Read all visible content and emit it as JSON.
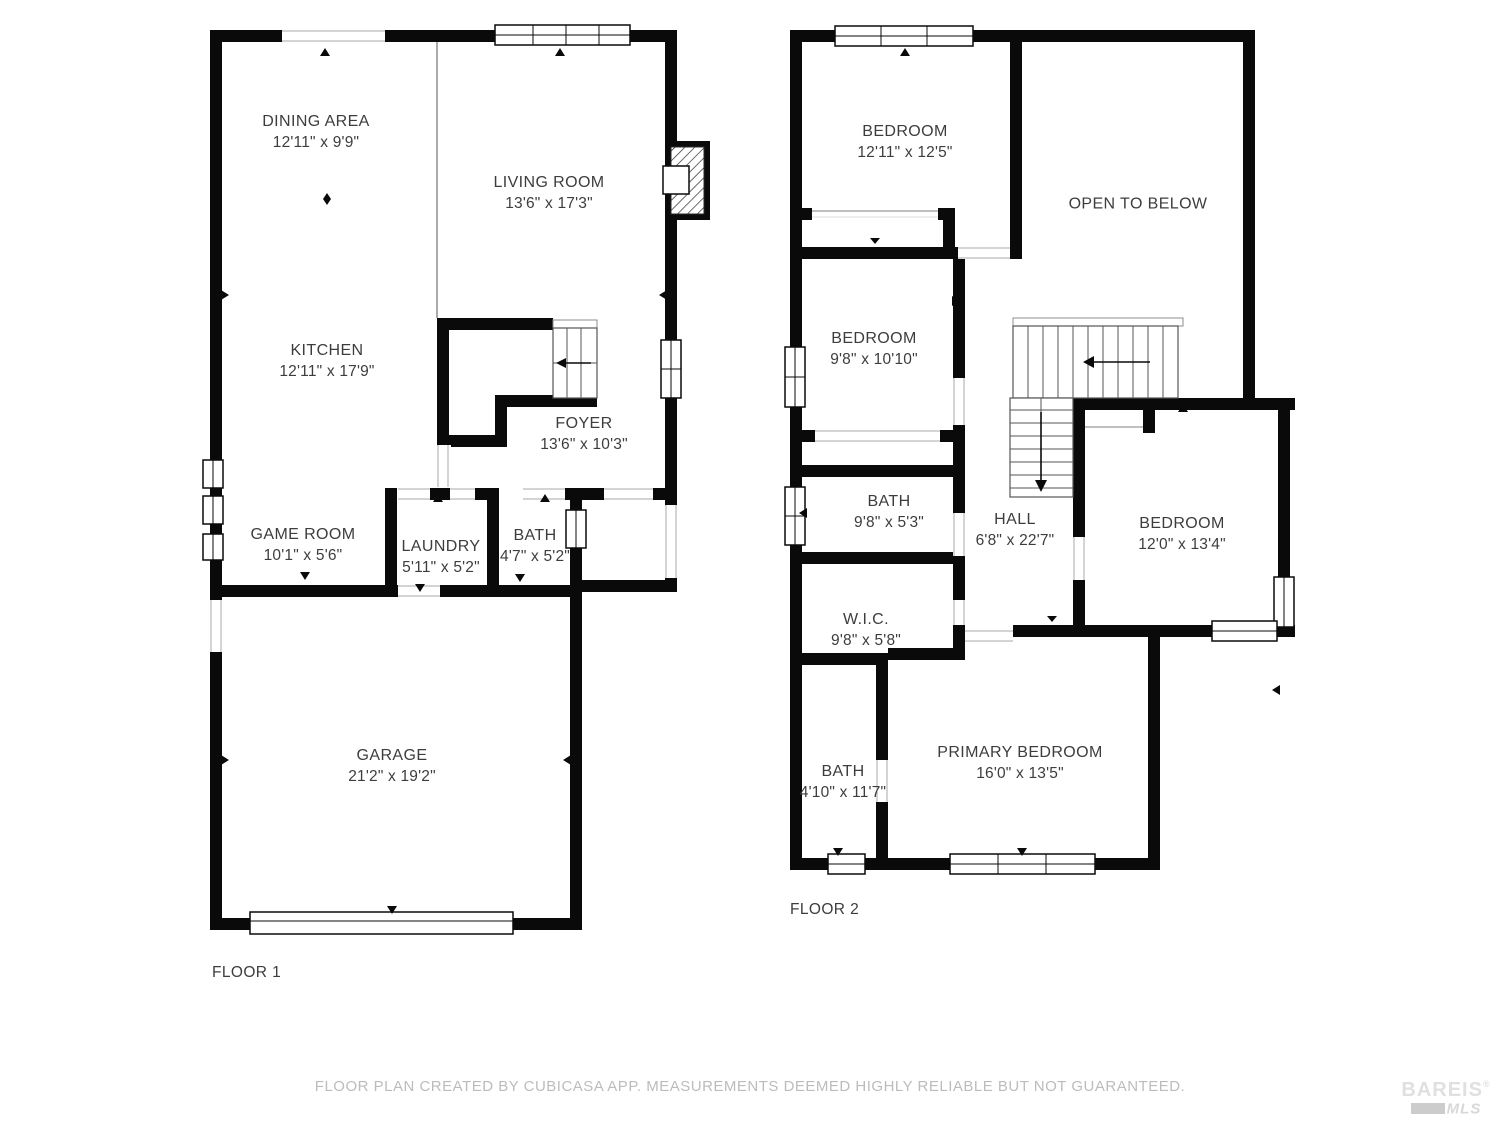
{
  "floors": [
    {
      "label": "FLOOR 1",
      "rooms": [
        {
          "name": "DINING AREA",
          "dims": "12'11\" x 9'9\""
        },
        {
          "name": "LIVING ROOM",
          "dims": "13'6\" x 17'3\""
        },
        {
          "name": "KITCHEN",
          "dims": "12'11\" x 17'9\""
        },
        {
          "name": "FOYER",
          "dims": "13'6\" x 10'3\""
        },
        {
          "name": "GAME ROOM",
          "dims": "10'1\" x 5'6\""
        },
        {
          "name": "LAUNDRY",
          "dims": "5'11\" x 5'2\""
        },
        {
          "name": "BATH",
          "dims": "4'7\" x 5'2\""
        },
        {
          "name": "GARAGE",
          "dims": "21'2\" x 19'2\""
        }
      ]
    },
    {
      "label": "FLOOR 2",
      "rooms": [
        {
          "name": "BEDROOM",
          "dims": "12'11\" x 12'5\""
        },
        {
          "name": "OPEN TO BELOW",
          "dims": ""
        },
        {
          "name": "BEDROOM",
          "dims": "9'8\" x 10'10\""
        },
        {
          "name": "BATH",
          "dims": "9'8\" x 5'3\""
        },
        {
          "name": "HALL",
          "dims": "6'8\" x 22'7\""
        },
        {
          "name": "BEDROOM",
          "dims": "12'0\" x 13'4\""
        },
        {
          "name": "W.I.C.",
          "dims": "9'8\" x 5'8\""
        },
        {
          "name": "BATH",
          "dims": "4'10\" x 11'7\""
        },
        {
          "name": "PRIMARY BEDROOM",
          "dims": "16'0\" x 13'5\""
        }
      ]
    }
  ],
  "footer": {
    "disclaimer": "FLOOR PLAN CREATED BY CUBICASA APP. MEASUREMENTS DEEMED HIGHLY RELIABLE BUT NOT GUARANTEED."
  },
  "logo": {
    "brand": "BAREIS",
    "reg": "®",
    "sub": "MLS"
  },
  "colors": {
    "wall": "#0a0a0a",
    "text": "#3d3d3d",
    "muted": "#bcbcbc"
  }
}
